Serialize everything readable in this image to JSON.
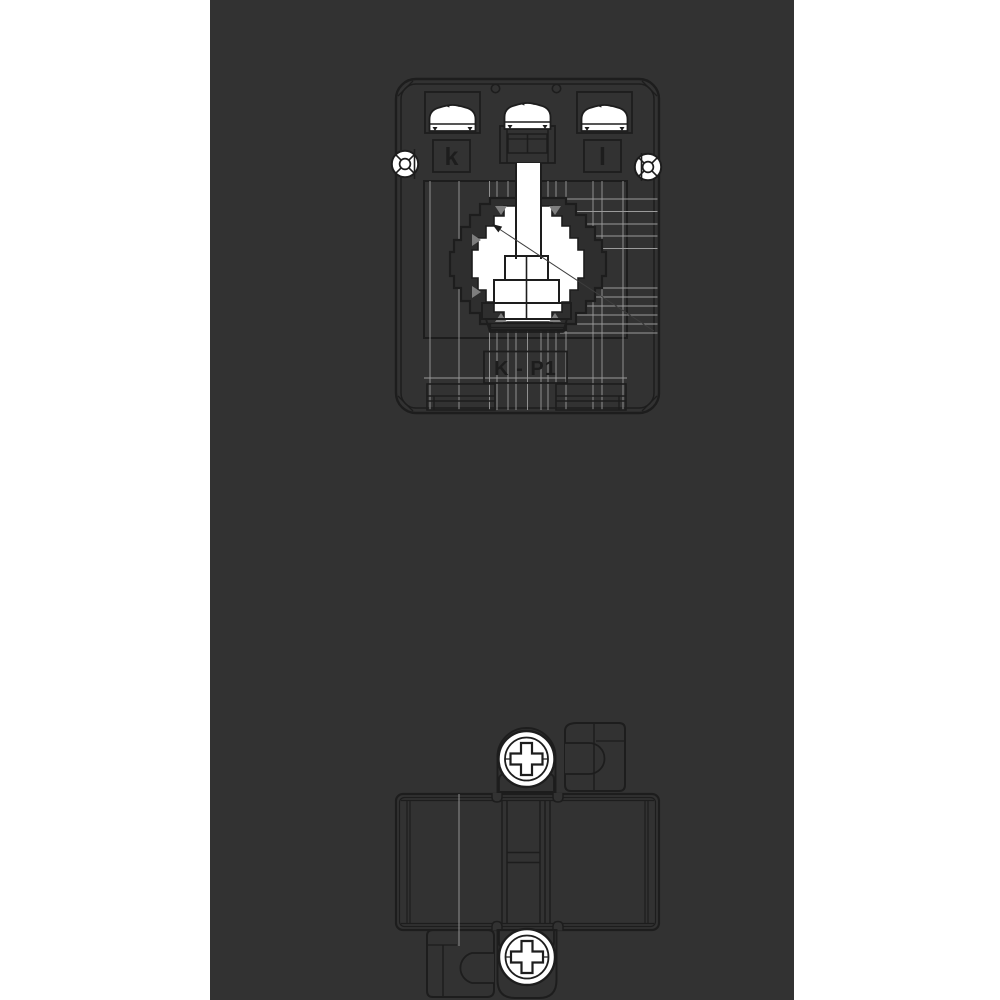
{
  "page": {
    "background_color": "#ffffff",
    "panel_color": "#323232"
  },
  "drawing": {
    "line_color": "#1d1d1d",
    "guide_line_color": "#9b9b9b",
    "shade_dark_color": "#2e2e2e",
    "shade_gray_color": "#7e7e7e",
    "front_view": {
      "terminal_left_label": "k",
      "terminal_right_label": "l",
      "polarity_label": "K - P1"
    }
  }
}
